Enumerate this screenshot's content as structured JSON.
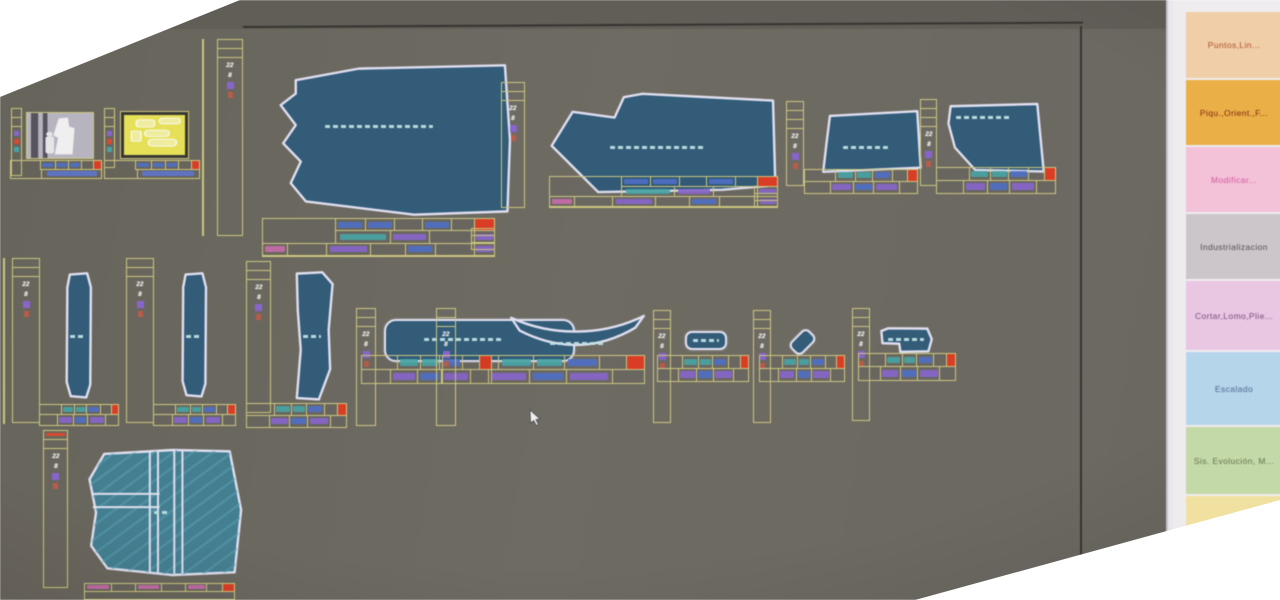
{
  "window": {
    "background_color": "#6c6861",
    "border_color": "#34322d",
    "description": "garment pattern CAD workspace"
  },
  "sidebar": {
    "background_color": "#f3eff3",
    "buttons": [
      {
        "id": "puntos",
        "label": "Puntos,Lin...",
        "bg": "#f6d0a6",
        "fg": "#c05a2e"
      },
      {
        "id": "piquetes-orient",
        "label": "Piqu.,Orient.,F...",
        "bg": "#f1b03c",
        "fg": "#942d12"
      },
      {
        "id": "modificar",
        "label": "Modificar...",
        "bg": "#fac2dc",
        "fg": "#e763ae"
      },
      {
        "id": "industrializacion",
        "label": "Industrializacion",
        "bg": "#cfc8cc",
        "fg": "#5c5660"
      },
      {
        "id": "cortar-lomo",
        "label": "Cortar,Lomo,Plie...",
        "bg": "#eec8e8",
        "fg": "#8a5488"
      },
      {
        "id": "escalado",
        "label": "Escalado",
        "bg": "#b5d8f0",
        "fg": "#51719c"
      },
      {
        "id": "sis-evolucion",
        "label": "Sis. Evolución, M...",
        "bg": "#c5dca6",
        "fg": "#6e7d55"
      },
      {
        "id": "extra",
        "label": "",
        "bg": "#f6e49c",
        "fg": "#8a7a40"
      }
    ]
  },
  "strip": {
    "size": "22",
    "count": "8"
  },
  "markers": {
    "red": "#e5391f",
    "purple": "#8a63d6",
    "orange": "#c05a44",
    "teal": "#3fa7a8",
    "blue": "#4a6fd0",
    "magenta": "#d06ab0"
  },
  "canvas": {
    "grid_color": "#cfc97a",
    "piece_fill": "#2e5b7c",
    "piece_fill_alt": "#3e8094",
    "outline_color": "#e2e2f4",
    "thumbnails": [
      {
        "id": "model-sketch",
        "name": "model sketch preview"
      },
      {
        "id": "model-pieces",
        "name": "model pieces preview"
      }
    ],
    "pieces": [
      {
        "id": "body-main",
        "name": "main body piece"
      },
      {
        "id": "sleeve",
        "name": "sleeve piece"
      },
      {
        "id": "yoke-left",
        "name": "yoke piece left"
      },
      {
        "id": "yoke-right",
        "name": "yoke piece right"
      },
      {
        "id": "band-1",
        "name": "narrow band 1"
      },
      {
        "id": "band-2",
        "name": "narrow band 2"
      },
      {
        "id": "band-3",
        "name": "narrow band 3"
      },
      {
        "id": "waistband",
        "name": "waistband"
      },
      {
        "id": "collar",
        "name": "curved collar"
      },
      {
        "id": "tab",
        "name": "small tab"
      },
      {
        "id": "loop",
        "name": "small loop"
      },
      {
        "id": "pocket",
        "name": "small pocket"
      },
      {
        "id": "front-panel",
        "name": "large front panel"
      }
    ]
  }
}
